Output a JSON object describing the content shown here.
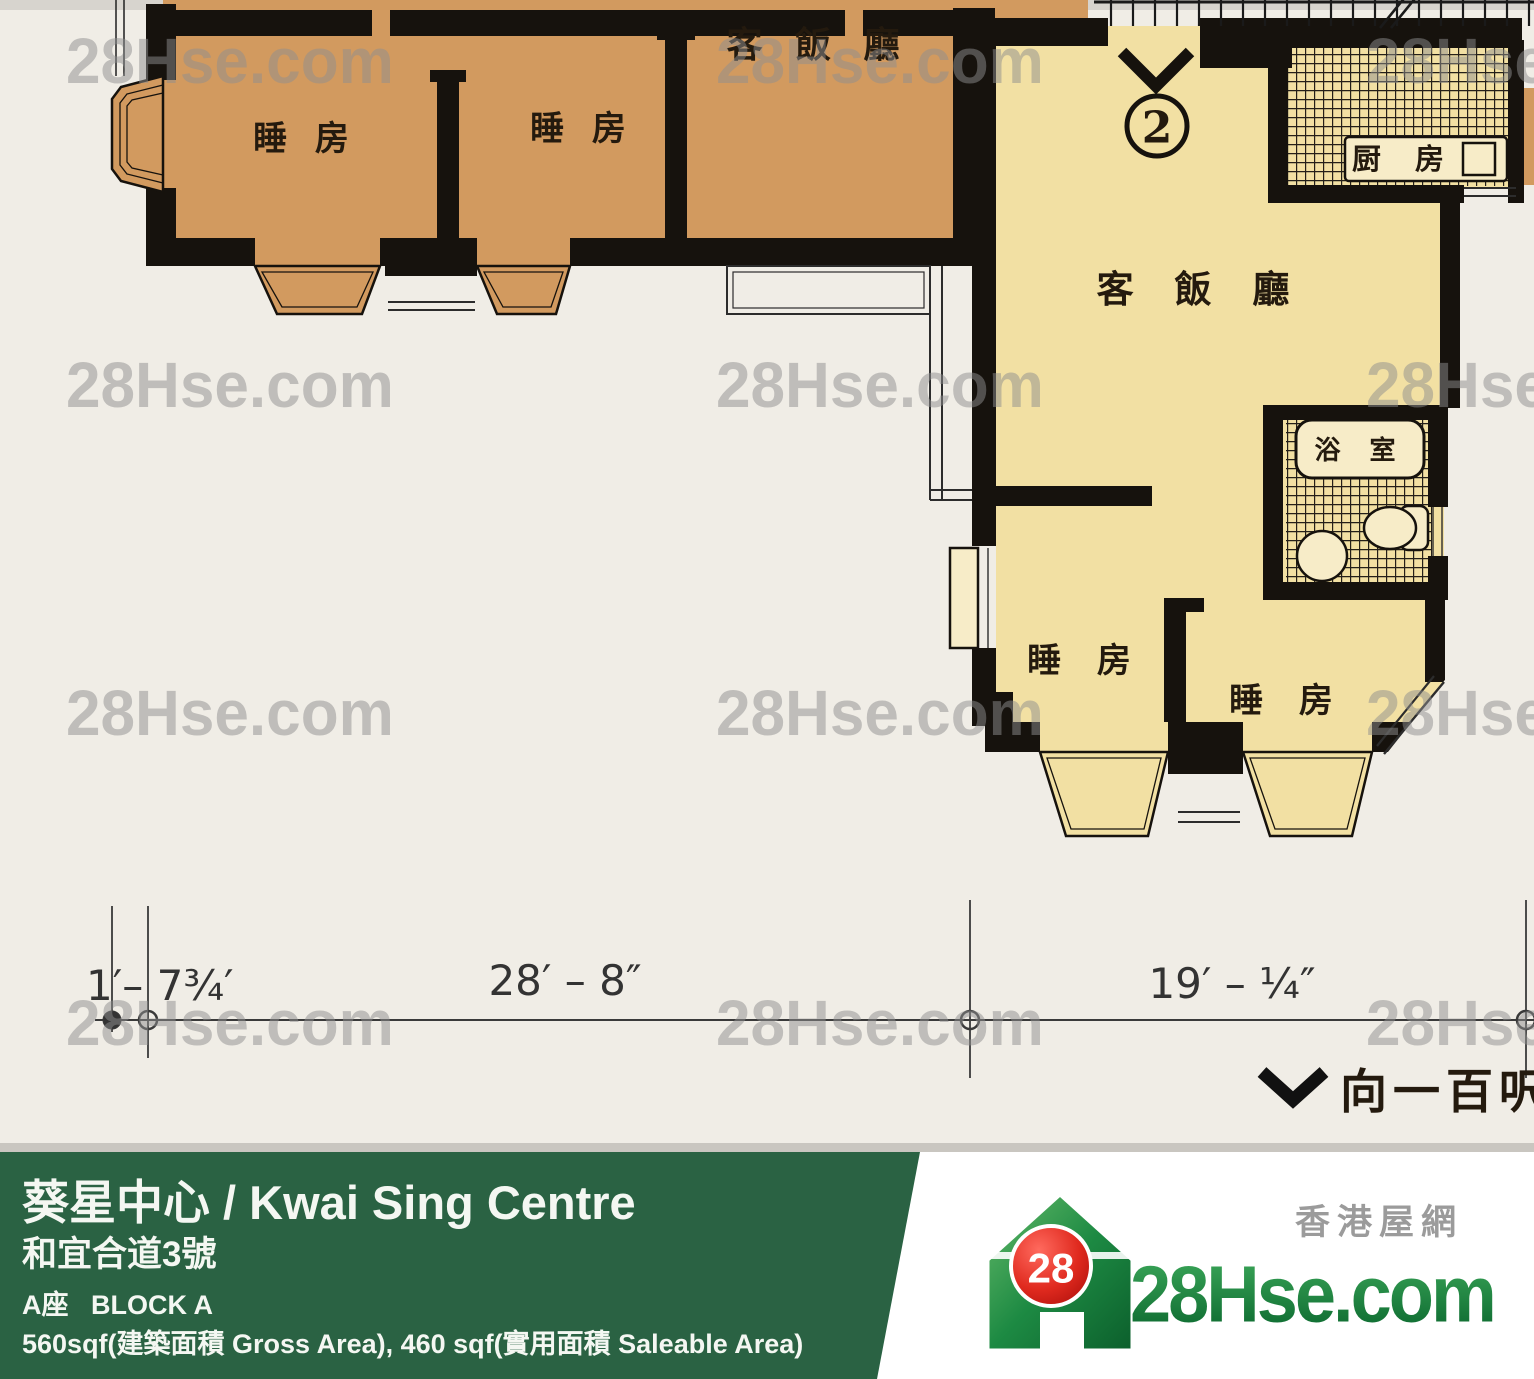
{
  "plan": {
    "unit_number": "2",
    "room_labels": {
      "living_dining": "客 飯 廳",
      "bedroom": "睡 房",
      "kitchen": "厨 房",
      "bathroom": "浴 室"
    },
    "dimensions": {
      "left": "1′– 7¾′",
      "middle": "28′ – 8″",
      "right": "19′ – ¼″"
    },
    "facing_note": "向一百呎闊"
  },
  "watermark": {
    "text": "28Hse.com"
  },
  "footer": {
    "building_name": "葵星中心 / Kwai Sing Centre",
    "address": "和宜合道3號",
    "block": "A座   BLOCK A",
    "area_info": "560sqf(建築面積 Gross Area), 460 sqf(實用面積 Saleable Area)",
    "logo": {
      "badge_number": "28",
      "brand": "28Hse.com",
      "tagline": "香港屋網"
    }
  },
  "colors": {
    "unit_a_fill": "#d29a5f",
    "unit_b_fill": "#f2e0a3",
    "fixture_fill": "#f7ecc8",
    "wall": "#16120d",
    "paper": "#f0ede6",
    "top_strip": "#d7d4ce",
    "watermark": "#8f8f8f",
    "footer_green": "#2a6243",
    "footer_gray_strip": "#c9c6c0",
    "brand_green_dark": "#0e6b31",
    "brand_green_light": "#3aa558",
    "badge_red": "#d81e1a",
    "tagline_gray": "#9b9b9b"
  }
}
